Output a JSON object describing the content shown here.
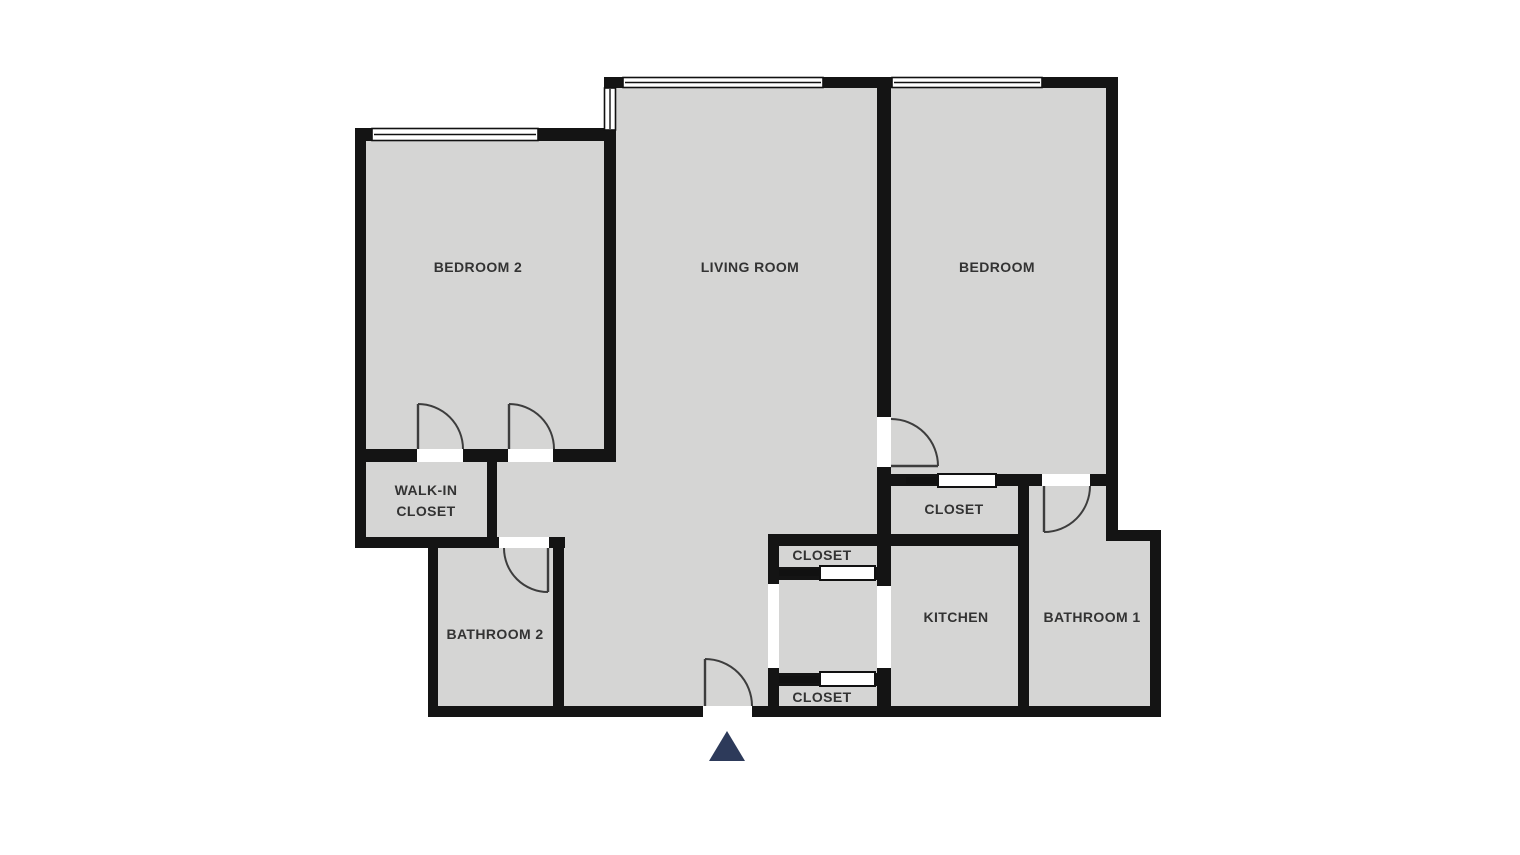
{
  "floorplan": {
    "colors": {
      "floor": "#d5d5d4",
      "wall": "#141414",
      "label": "#333333",
      "opening": "#ffffff",
      "entry_marker": "#2d3a5a"
    },
    "rooms": [
      {
        "id": "bedroom-2",
        "label": "BEDROOM 2"
      },
      {
        "id": "living-room",
        "label": "LIVING ROOM"
      },
      {
        "id": "bedroom",
        "label": "BEDROOM"
      },
      {
        "id": "walk-in-closet",
        "line1": "WALK-IN",
        "line2": "CLOSET"
      },
      {
        "id": "bathroom-2",
        "label": "BATHROOM 2"
      },
      {
        "id": "entry-closet-upper",
        "label": "CLOSET"
      },
      {
        "id": "entry-closet-lower",
        "label": "CLOSET"
      },
      {
        "id": "bedroom-closet",
        "label": "CLOSET"
      },
      {
        "id": "kitchen",
        "label": "KITCHEN"
      },
      {
        "id": "bathroom-1",
        "label": "BATHROOM 1"
      }
    ],
    "entry_marker": {
      "icon": "entrance-triangle"
    }
  }
}
